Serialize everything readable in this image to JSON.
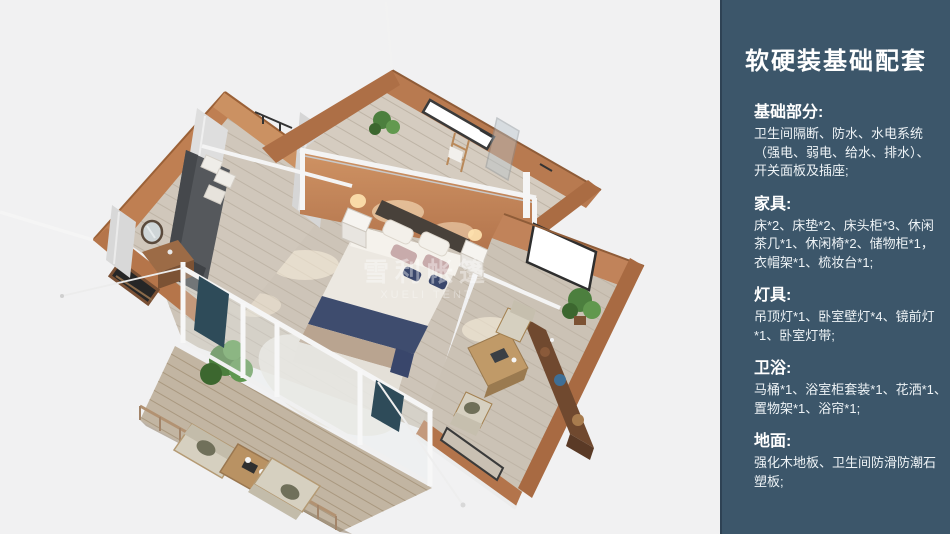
{
  "panel": {
    "title": "软硬装基础配套",
    "bg_color": "#3c566a",
    "text_color": "#ffffff",
    "sections": [
      {
        "heading": "基础部分:",
        "body": "卫生间隔断、防水、水电系统\n（强电、弱电、给水、排水）、\n开关面板及插座;"
      },
      {
        "heading": "家具:",
        "body": "床*2、床垫*2、床头柜*3、休闲\n茶几*1、休闲椅*2、储物柜*1，\n衣帽架*1、梳妆台*1;"
      },
      {
        "heading": "灯具:",
        "body": "吊顶灯*1、卧室壁灯*4、镜前灯\n*1、卧室灯带;"
      },
      {
        "heading": "卫浴:",
        "body": "马桶*1、浴室柜套装*1、花洒*1、\n置物架*1、浴帘*1;"
      },
      {
        "heading": "地面:",
        "body": "强化木地板、卫生间防滑防潮石\n塑板;"
      }
    ]
  },
  "scene": {
    "watermark_line1": "雪利帐篷",
    "watermark_line2": "XUELI TENT",
    "subject": "安全帐篷套房三维俯视效果图",
    "colors": {
      "background": "#f1f1f2",
      "tent_wall_tan": "#c2885a",
      "indoor_floor": "#cdc4b8",
      "deck_wood": "#c2b5a2",
      "frame_white": "#f5f5f5",
      "bed_runner_navy": "#3e4c6e",
      "curtain_teal": "#2e4b59",
      "plant_green": "#4c7f3e"
    }
  }
}
